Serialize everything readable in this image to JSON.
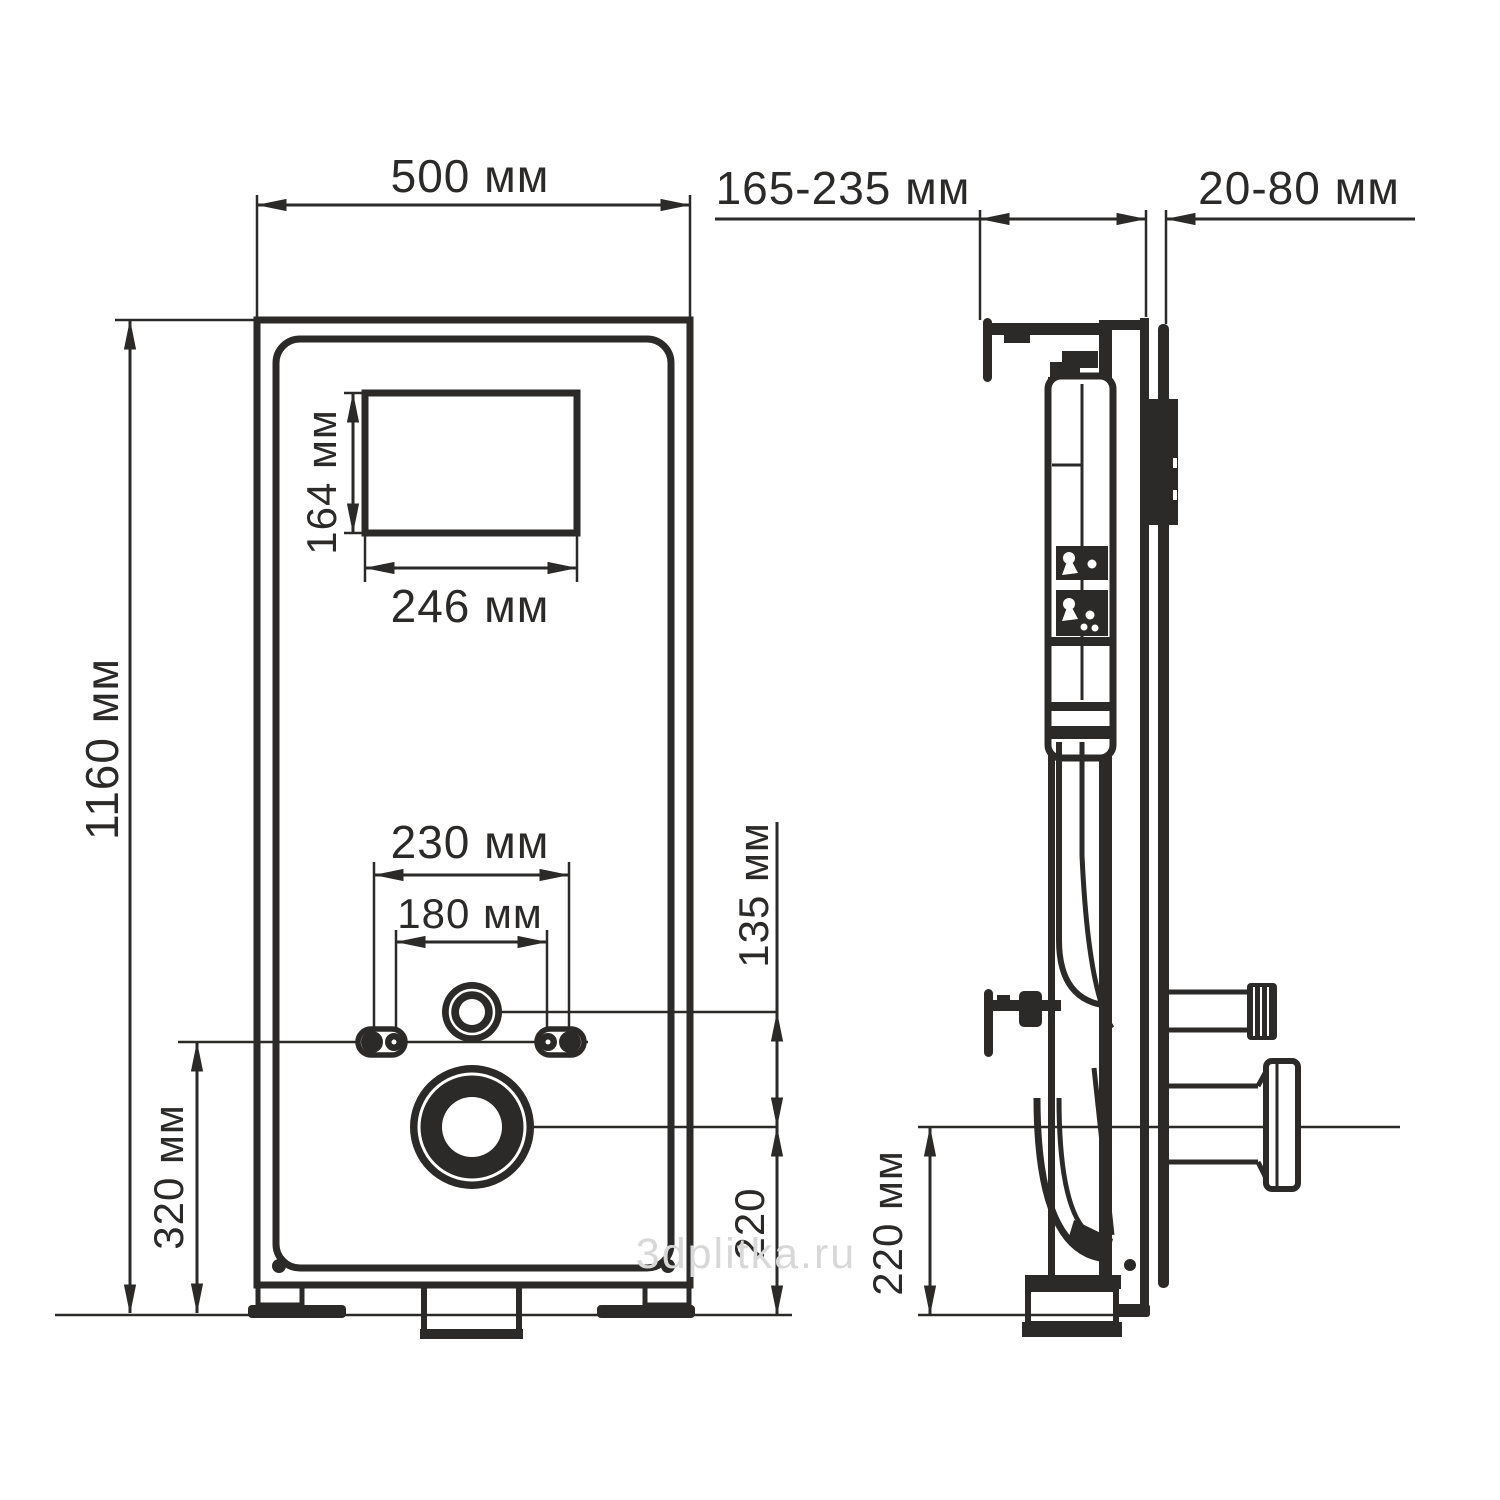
{
  "drawing": {
    "watermark": "3dplitka.ru",
    "colors": {
      "line": "#2b2a29",
      "watermark": "#d8d8d8",
      "background": "#ffffff"
    },
    "front_view": {
      "name": "front view of concealed cistern installation frame",
      "dims": {
        "width": "500 мм",
        "height": "1160 мм",
        "plate_window_height": "164 мм",
        "plate_window_width": "246 мм",
        "fixing_outer_span": "230 мм",
        "fixing_inner_span": "180 мм",
        "inlet_to_drain": "135 мм",
        "fixing_to_floor": "320 мм",
        "drain_to_floor": "220"
      }
    },
    "side_view": {
      "name": "side view of concealed cistern installation frame",
      "dims": {
        "frame_depth": "165-235 мм",
        "finish_gap": "20-80 мм",
        "drain_to_floor": "220 мм"
      }
    }
  }
}
